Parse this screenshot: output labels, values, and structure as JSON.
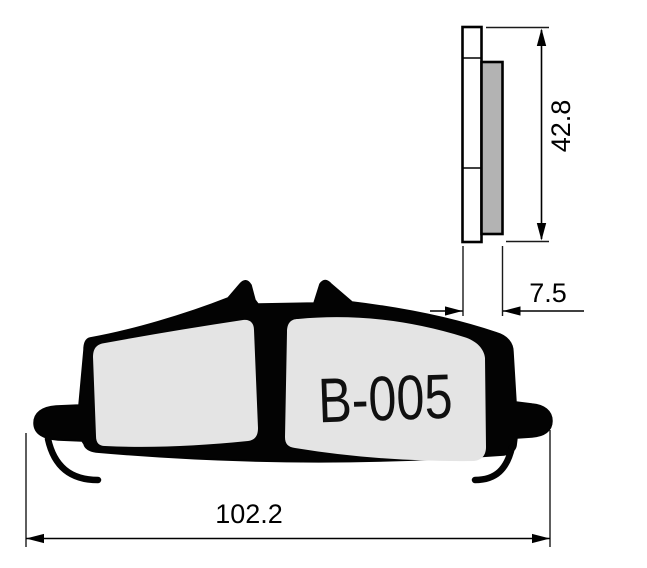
{
  "drawing": {
    "part_label": "B-005",
    "dimensions": {
      "height_mm": "42.8",
      "thickness_mm": "7.5",
      "width_mm": "102.2"
    },
    "colors": {
      "background": "#ffffff",
      "line": "#000000",
      "plate_fill": "#ffffff",
      "friction_side_fill": "#b3b3b3",
      "pad_front_fill": "#e4e4e4"
    }
  }
}
